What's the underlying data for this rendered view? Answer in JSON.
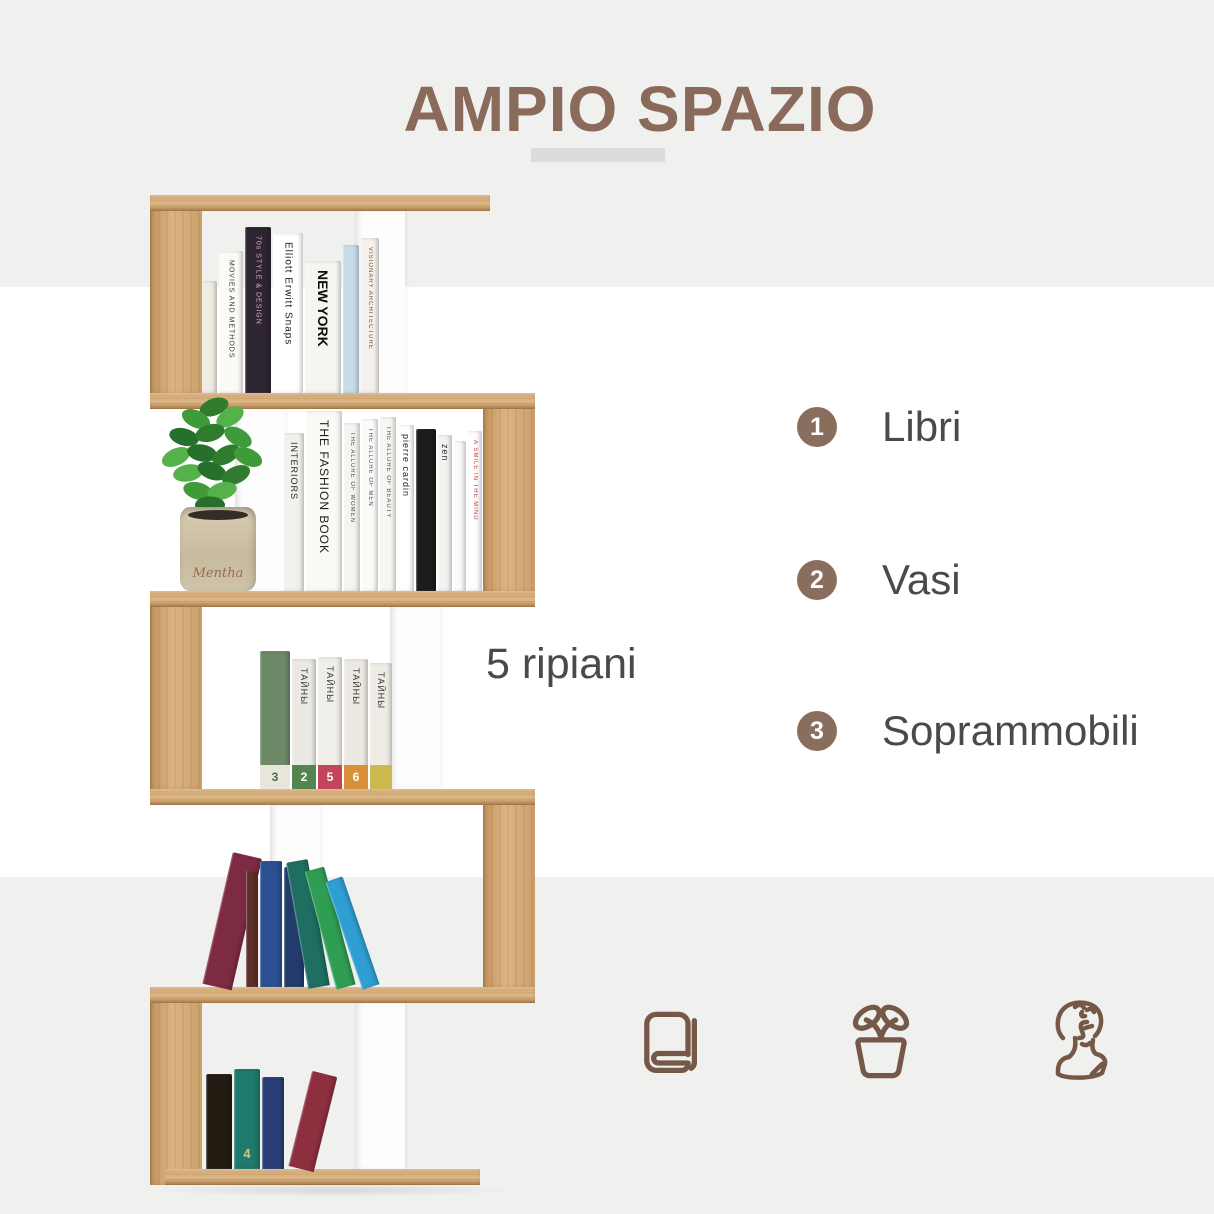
{
  "colors": {
    "band": "#f0f0ef",
    "white": "#ffffff",
    "brand_brown": "#8a6a5a",
    "underline": "#dcdcdc",
    "badge": "#8a6e5d",
    "text": "#4c4947",
    "icon_stroke": "#755847",
    "white_panel": "#fdfdfd"
  },
  "title": {
    "text": "AMPIO SPAZIO"
  },
  "caption": {
    "text": "5 ripiani"
  },
  "features": [
    {
      "number": "1",
      "label": "Libri"
    },
    {
      "number": "2",
      "label": "Vasi"
    },
    {
      "number": "3",
      "label": "Soprammobili"
    }
  ],
  "icons": [
    {
      "name": "book-icon"
    },
    {
      "name": "plant-pot-icon"
    },
    {
      "name": "bust-icon"
    }
  ],
  "bookshelf": {
    "geometry": {
      "left": 150,
      "top": 195,
      "width": 385,
      "height": 990,
      "tier_height": 198,
      "shelf_thickness": 16,
      "panel_width": 52,
      "divider_width": 50
    },
    "shelves": [
      {
        "x": 0,
        "y": 0,
        "w": 340
      },
      {
        "x": 0,
        "y": 198,
        "w": 385
      },
      {
        "x": 0,
        "y": 396,
        "w": 385
      },
      {
        "x": 0,
        "y": 594,
        "w": 385
      },
      {
        "x": 0,
        "y": 792,
        "w": 385
      },
      {
        "x": 15,
        "y": 974,
        "w": 315
      }
    ],
    "panels": [
      {
        "tier": 0,
        "side": "left"
      },
      {
        "tier": 1,
        "side": "right"
      },
      {
        "tier": 2,
        "side": "left"
      },
      {
        "tier": 3,
        "side": "right"
      },
      {
        "tier": 4,
        "side": "left"
      }
    ],
    "dividers": [
      {
        "tier": 0,
        "x": 205
      },
      {
        "tier": 1,
        "x": 85
      },
      {
        "tier": 2,
        "x": 240
      },
      {
        "tier": 3,
        "x": 120
      },
      {
        "tier": 4,
        "x": 205
      }
    ],
    "tiers": [
      {
        "bottom": 198,
        "books": [
          {
            "x": 52,
            "w": 15,
            "h": 112,
            "color": "#f0ece4"
          },
          {
            "x": 69,
            "w": 24,
            "h": 142,
            "color": "#fbfaf7",
            "label": "MOVIES AND METHODS",
            "label_color": "#333333",
            "fs": 7
          },
          {
            "x": 95,
            "w": 26,
            "h": 166,
            "color": "#2d2531",
            "label": "70s STYLE & DESIGN",
            "label_color": "#e0aec2",
            "fs": 7
          },
          {
            "x": 123,
            "w": 30,
            "h": 160,
            "color": "#ffffff",
            "label": "Elliott Erwitt Snaps",
            "label_color": "#1c1c1c",
            "fs": 10
          },
          {
            "x": 155,
            "w": 36,
            "h": 132,
            "color": "#f6f5f2",
            "label": "NEW YORK",
            "label_color": "#0d0d0d",
            "fs": 14,
            "bold": true
          },
          {
            "x": 193,
            "w": 16,
            "h": 148,
            "color": "#c7dde9"
          },
          {
            "x": 211,
            "w": 18,
            "h": 155,
            "color": "#f4f1ec",
            "label": "VISIONARY ARCHITECTURE",
            "label_color": "#7a4a32",
            "fs": 6
          }
        ]
      },
      {
        "bottom": 396,
        "books": [
          {
            "x": 134,
            "w": 20,
            "h": 158,
            "color": "#f3f1ec",
            "label": "INTERIORS",
            "label_color": "#2b2b2b",
            "fs": 9
          },
          {
            "x": 156,
            "w": 36,
            "h": 180,
            "color": "#faf9f6",
            "label": "THE FASHION BOOK",
            "label_color": "#1f1f1f",
            "fs": 12
          },
          {
            "x": 194,
            "w": 16,
            "h": 168,
            "color": "#f6f4f0",
            "label": "THE ALLURE OF WOMEN",
            "label_color": "#4a4a4a",
            "fs": 6
          },
          {
            "x": 212,
            "w": 16,
            "h": 172,
            "color": "#fcfbf9",
            "label": "THE ALLURE OF MEN",
            "label_color": "#4a4a4a",
            "fs": 6
          },
          {
            "x": 230,
            "w": 16,
            "h": 174,
            "color": "#f7f6f2",
            "label": "THE ALLURE OF BEAUTY",
            "label_color": "#4a4a4a",
            "fs": 6
          },
          {
            "x": 248,
            "w": 16,
            "h": 166,
            "color": "#ffffff",
            "label": "pierre cardin",
            "label_color": "#222222",
            "fs": 9
          },
          {
            "x": 266,
            "w": 20,
            "h": 162,
            "color": "#1c1b1d"
          },
          {
            "x": 288,
            "w": 14,
            "h": 156,
            "color": "#f4f3ef",
            "label": "zen",
            "label_color": "#333333",
            "fs": 9
          },
          {
            "x": 304,
            "w": 12,
            "h": 150,
            "color": "#fbfaf8"
          },
          {
            "x": 318,
            "w": 14,
            "h": 160,
            "color": "#fefefe",
            "label": "A SMILE IN THE MIND",
            "label_color": "#cc3333",
            "fs": 6
          }
        ]
      },
      {
        "bottom": 594,
        "books": [
          {
            "x": 110,
            "w": 30,
            "h": 138,
            "color": "#6d8866",
            "band": "#e8e5dc",
            "num": "3",
            "num_color": "#4a6b4a"
          },
          {
            "x": 142,
            "w": 24,
            "h": 130,
            "color": "#ebe9e3",
            "label": "ТАЙНЫ",
            "label_color": "#3a3a3a",
            "fs": 9,
            "band": "#55854f",
            "num": "2"
          },
          {
            "x": 168,
            "w": 24,
            "h": 132,
            "color": "#f0eee8",
            "label": "ТАЙНЫ",
            "label_color": "#3a3a3a",
            "fs": 9,
            "band": "#c2455a",
            "num": "5"
          },
          {
            "x": 194,
            "w": 24,
            "h": 130,
            "color": "#ece9e2",
            "label": "ТАЙНЫ",
            "label_color": "#3a3a3a",
            "fs": 9,
            "band": "#d8903b",
            "num": "6"
          },
          {
            "x": 220,
            "w": 22,
            "h": 126,
            "color": "#efece5",
            "label": "ТАЙНЫ",
            "label_color": "#3a3a3a",
            "fs": 9,
            "band": "#cdb84e",
            "num": ""
          }
        ]
      },
      {
        "bottom": 792,
        "books": [
          {
            "x": 52,
            "w": 30,
            "h": 135,
            "color": "#7d2b43",
            "tilt": 13
          },
          {
            "x": 96,
            "w": 12,
            "h": 116,
            "color": "#5e3027"
          },
          {
            "x": 110,
            "w": 22,
            "h": 126,
            "color": "#2c4f92"
          },
          {
            "x": 134,
            "w": 20,
            "h": 120,
            "color": "#233a6d"
          },
          {
            "x": 158,
            "w": 22,
            "h": 128,
            "color": "#1e6e62",
            "tilt": -10
          },
          {
            "x": 186,
            "w": 20,
            "h": 122,
            "color": "#2f9e52",
            "tilt": -15
          },
          {
            "x": 212,
            "w": 18,
            "h": 114,
            "color": "#2f9ed2",
            "tilt": -19
          }
        ]
      },
      {
        "bottom": 974,
        "books": [
          {
            "x": 56,
            "w": 26,
            "h": 95,
            "color": "#231c13"
          },
          {
            "x": 84,
            "w": 26,
            "h": 100,
            "color": "#1e7a6c",
            "num": "4",
            "num_color": "#d8c27a"
          },
          {
            "x": 112,
            "w": 22,
            "h": 92,
            "color": "#293e77"
          },
          {
            "x": 138,
            "w": 26,
            "h": 98,
            "color": "#8d2f3f",
            "tilt": 14
          }
        ]
      }
    ],
    "plant": {
      "pot_label": "Mentha",
      "pot_color": "#c9bda5",
      "leaf_colors": [
        "#2f7c2f",
        "#3f9a3a",
        "#54b24a",
        "#27702c"
      ]
    }
  }
}
